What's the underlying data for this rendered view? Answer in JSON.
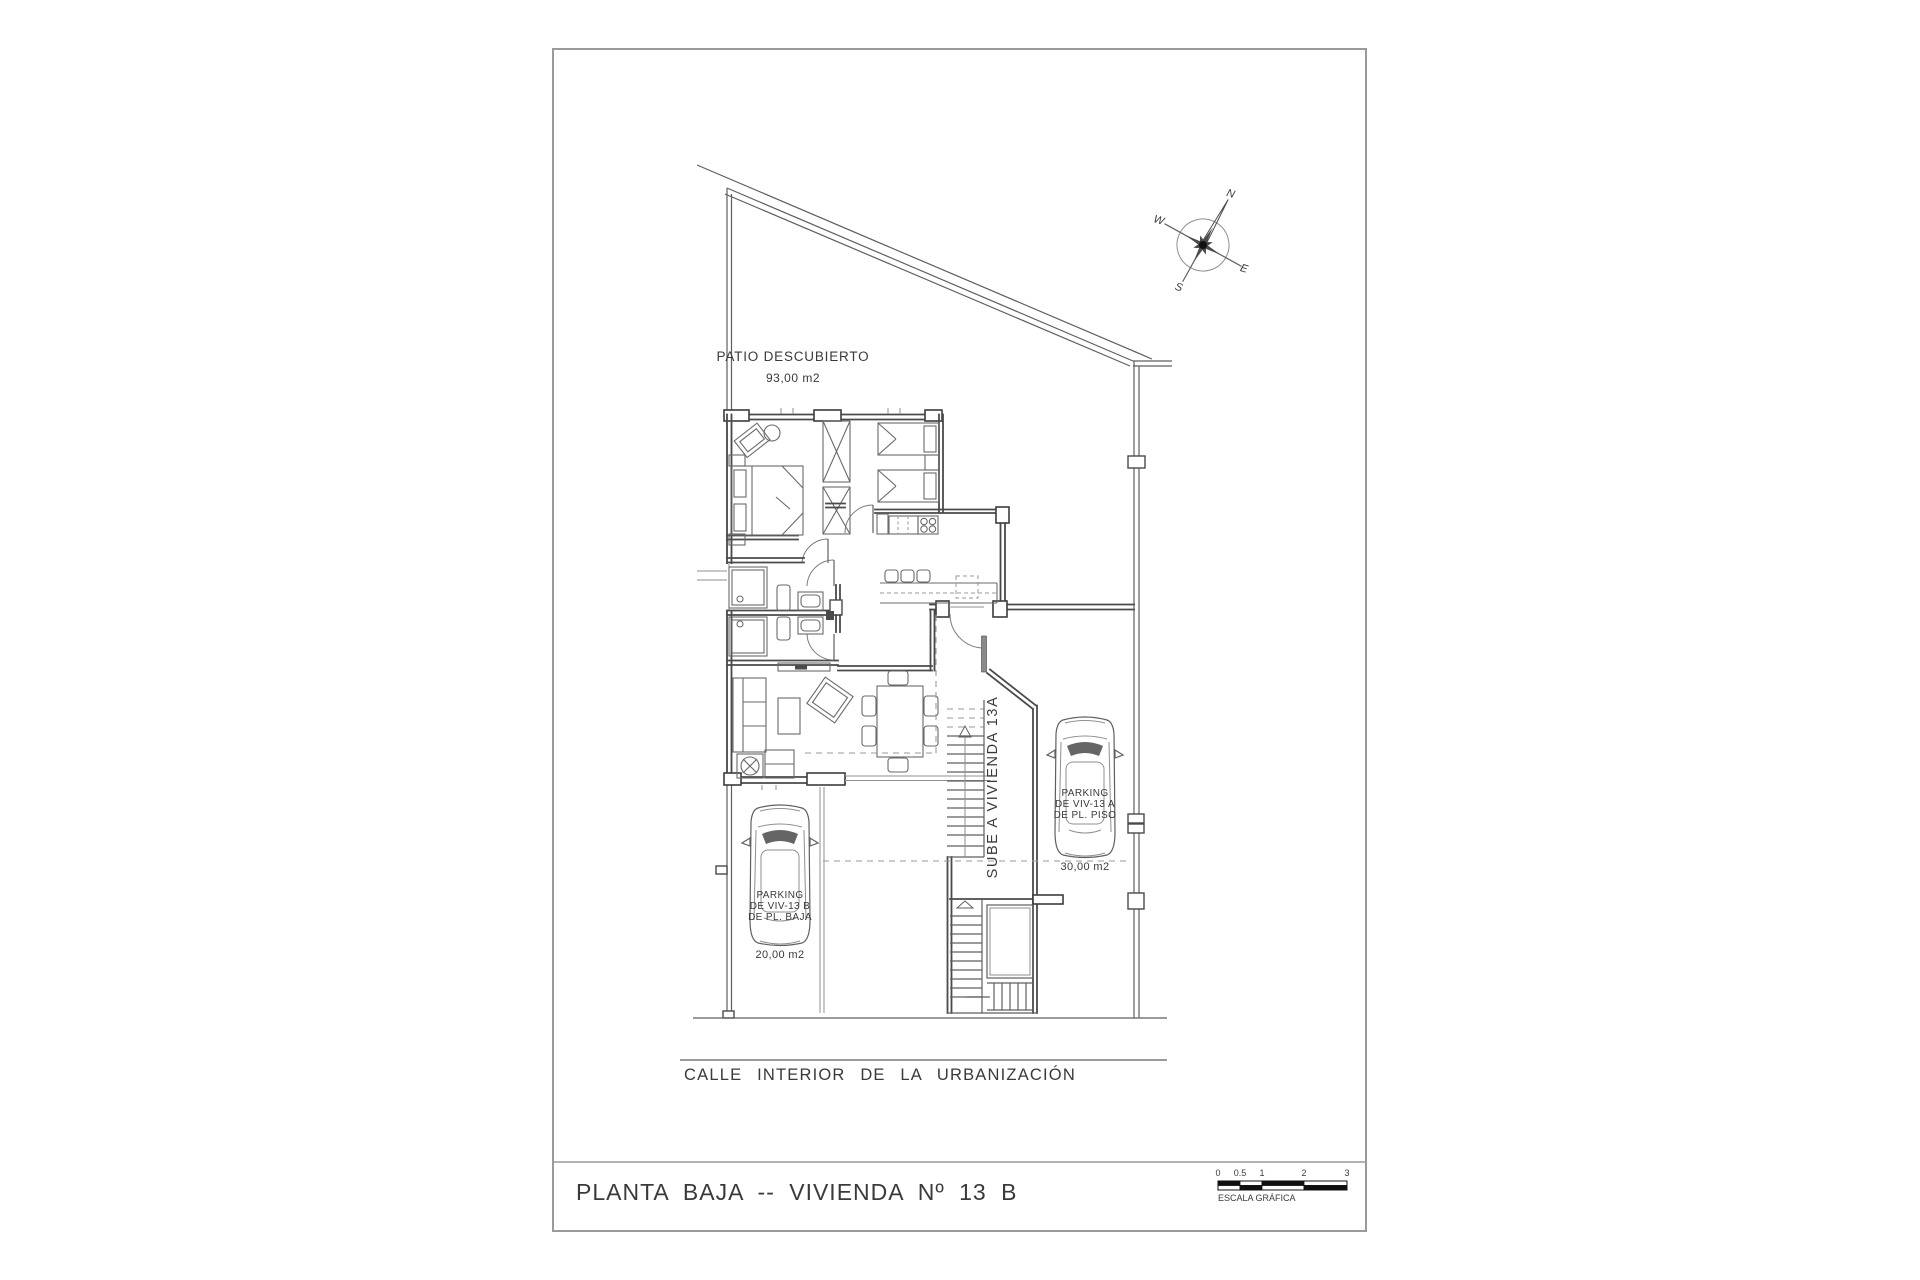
{
  "sheet": {
    "title": "PLANTA BAJA -- VIVIENDA Nº 13 B"
  },
  "plan": {
    "patio": {
      "label": "PATIO DESCUBIERTO",
      "area": "93,00 m2"
    },
    "stairs_label": "SUBE A VIVIENDA 13A",
    "parking_13a": {
      "line1": "PARKING",
      "line2": "DE VIV-13 A",
      "line3": "DE PL. PISO",
      "area": "30,00 m2"
    },
    "parking_13b": {
      "line1": "PARKING",
      "line2": "DE VIV-13 B",
      "line3": "DE PL. BAJA",
      "area": "20,00 m2"
    },
    "street": "CALLE INTERIOR DE LA URBANIZACIÓN"
  },
  "compass": {
    "n": "N",
    "e": "E",
    "s": "S",
    "w": "W"
  },
  "scale_bar": {
    "ticks": [
      "0",
      "0.5",
      "1",
      "2",
      "3"
    ],
    "label": "ESCALA GRÁFICA"
  },
  "colors": {
    "sheet_border": "#9a9a9a",
    "wall": "#3c3c3c",
    "line": "#5f5f5f",
    "text": "#3a3a3a"
  }
}
